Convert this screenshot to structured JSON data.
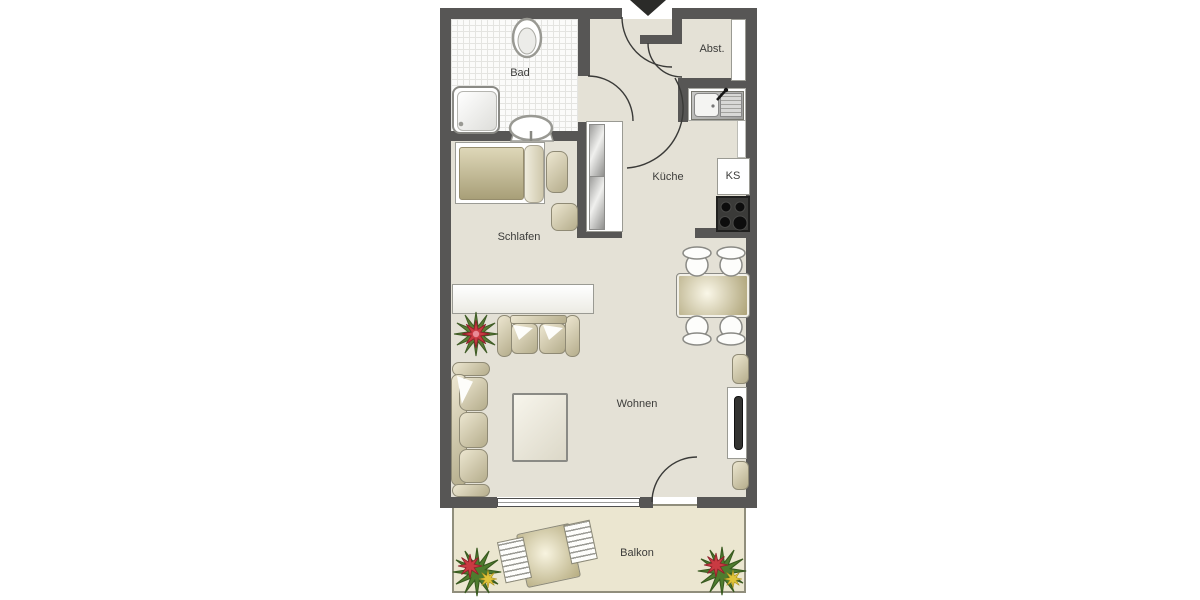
{
  "floorplan": {
    "labels": {
      "bad": "Bad",
      "abstellraum": "Abst.",
      "kueche": "Küche",
      "kuehlschrank": "KS",
      "schlafen": "Schlafen",
      "wohnen": "Wohnen",
      "balkon": "Balkon"
    },
    "colors": {
      "wall": "#575655",
      "floor": "#e4e1d6",
      "bathroom_tile": "#fbfbfa",
      "balcony_floor": "#ebe6d0",
      "furniture_beige": "#c9c19e",
      "stove_dark": "#3a3a38",
      "plant_red": "#c93a42",
      "plant_green": "#5b7d34",
      "plant_yellow": "#e0c43a"
    }
  }
}
